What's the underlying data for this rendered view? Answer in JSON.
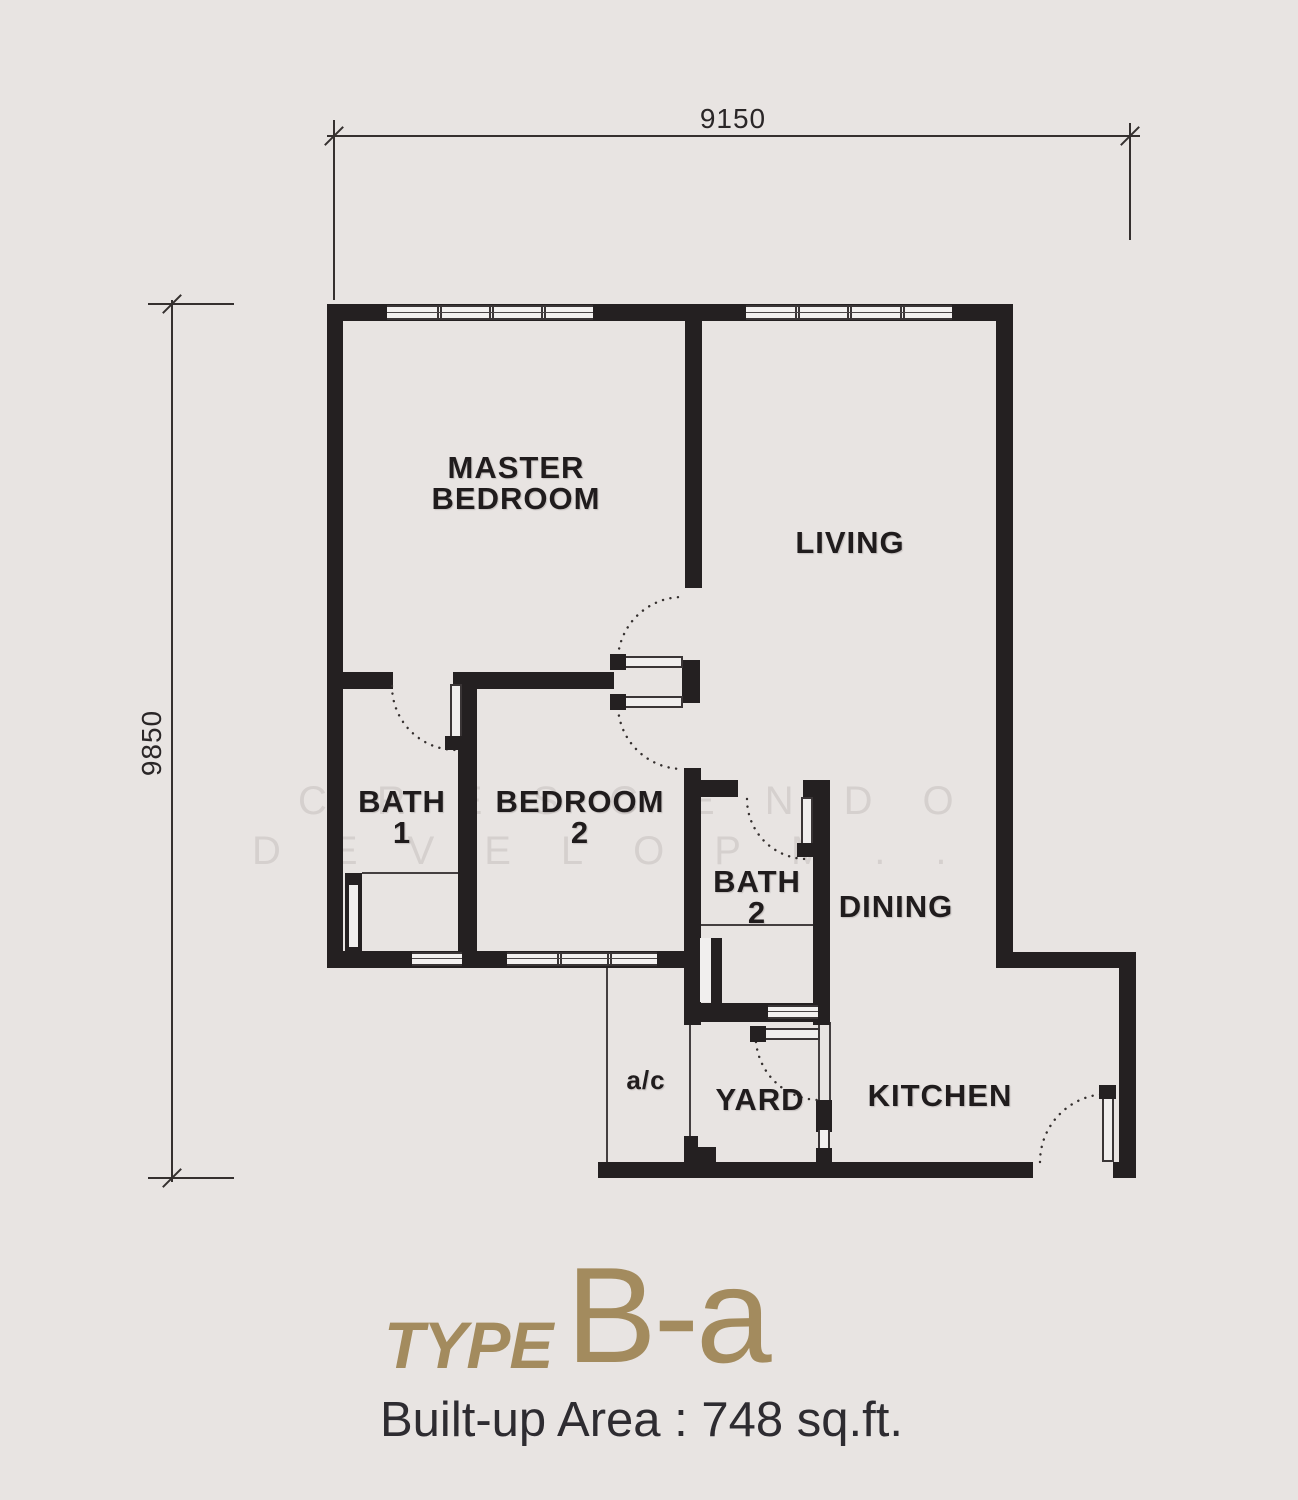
{
  "title": {
    "type_label": "TYPE",
    "type_value": "B-a",
    "area_text": "Built-up Area : 748 sq.ft.",
    "accent_color": "#a38b5e"
  },
  "dimensions": {
    "top": "9150",
    "left": "9850"
  },
  "rooms": {
    "master_bedroom": {
      "lines": [
        "MASTER",
        "BEDROOM"
      ]
    },
    "living": {
      "label": "LIVING"
    },
    "bath1": {
      "lines": [
        "BATH",
        "1"
      ]
    },
    "bedroom2": {
      "lines": [
        "BEDROOM",
        "2"
      ]
    },
    "bath2": {
      "lines": [
        "BATH",
        "2"
      ]
    },
    "dining": {
      "label": "DINING"
    },
    "ac": {
      "label": "a/c"
    },
    "yard": {
      "label": "YARD"
    },
    "kitchen": {
      "label": "KITCHEN"
    }
  },
  "watermark": {
    "line1": "CRESCENDO",
    "line2": "DEVELOPM..."
  },
  "colors": {
    "wall": "#242021",
    "background": "#e8e4e2",
    "dimension": "#35302f"
  }
}
